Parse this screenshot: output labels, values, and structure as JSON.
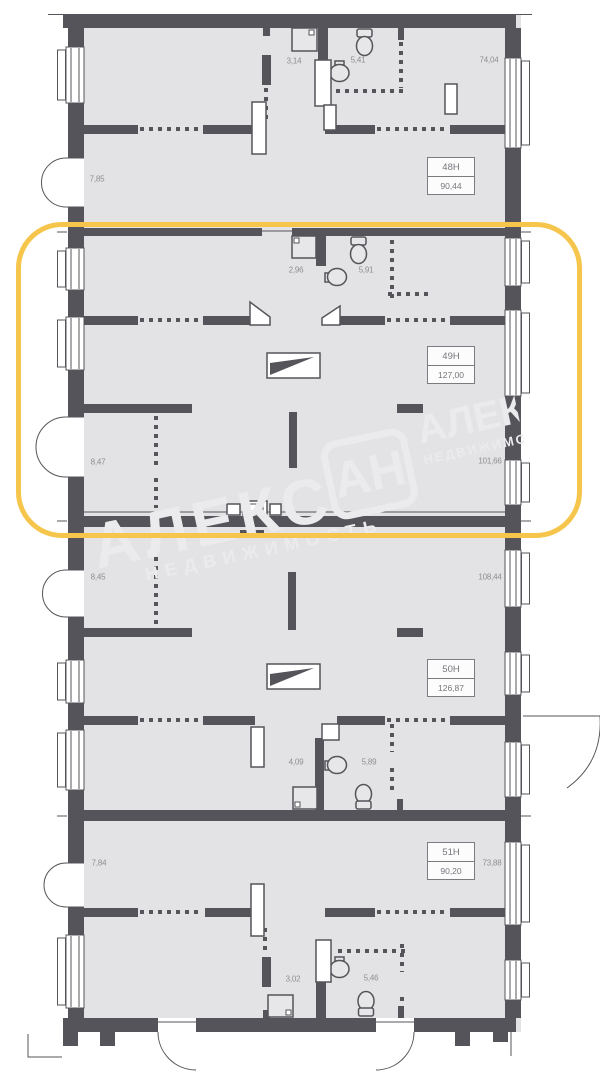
{
  "plan": {
    "watermark": {
      "brand_big": "АЛЕКС",
      "brand_sub": "НЕДВИЖИМОСТЬ",
      "logo": "АН"
    },
    "highlight": {
      "highlighted_unit": "49Н",
      "color": "#F6C54B"
    },
    "units": [
      {
        "number": "48Н",
        "area": "90,44",
        "dims": [
          "3,14",
          "5,41",
          "74,04",
          "7,85"
        ]
      },
      {
        "number": "49Н",
        "area": "127,00",
        "dims": [
          "2,96",
          "5,91",
          "8,47",
          "101,66"
        ]
      },
      {
        "number": "50Н",
        "area": "126,87",
        "dims": [
          "8,45",
          "108,44",
          "4,09",
          "5,89"
        ]
      },
      {
        "number": "51Н",
        "area": "90,20",
        "dims": [
          "7,84",
          "73,88",
          "3,02",
          "5,46"
        ]
      }
    ]
  }
}
